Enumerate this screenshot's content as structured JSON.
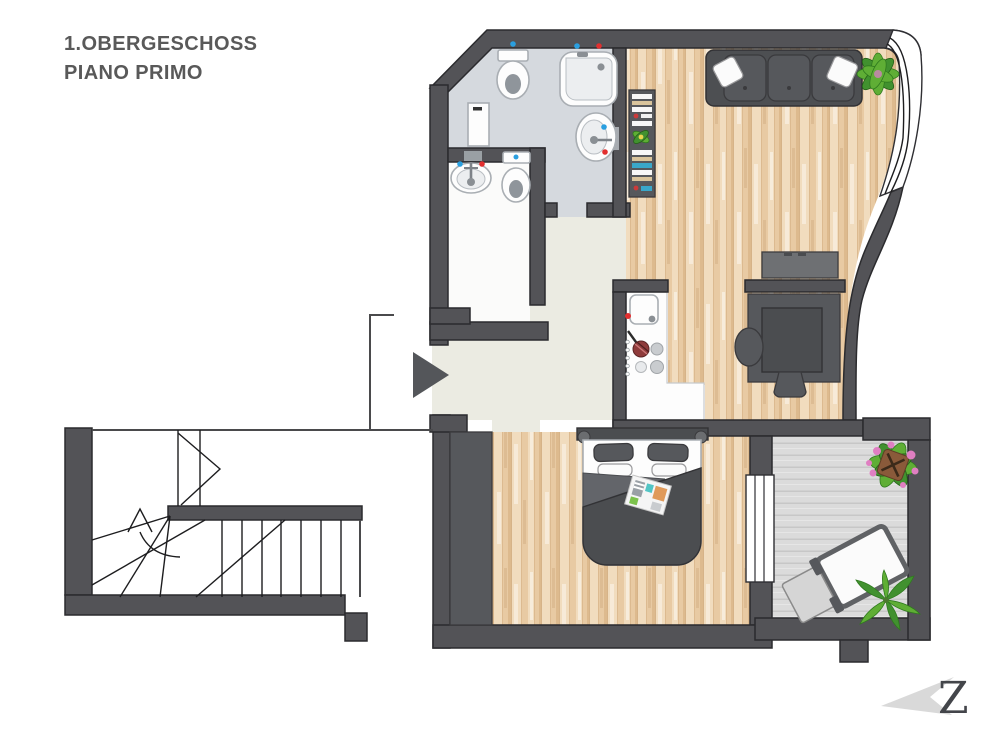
{
  "title": {
    "line1": "1.OBERGESCHOSS",
    "line2": "PIANO PRIMO"
  },
  "logo": {
    "letter": "Z"
  },
  "palette": {
    "wall": "#535357",
    "outline": "#2b2b2e",
    "bath_floor": "#d5d9de",
    "wc_floor": "#fbfbfa",
    "hall_floor": "#ebebe2",
    "wood_mid": "#e8caa3",
    "wood_light": "#f1dcbe",
    "wood_dark": "#ddba8e",
    "wood_grain": "#d2ae84",
    "deck": "#dbdbdb",
    "deck_line": "#c7c7c7",
    "furniture_dark": "#4b4d50",
    "furniture_mid": "#56585c",
    "furniture_light": "#6e7073",
    "accent_cold": "#2a9fe0",
    "accent_hot": "#e22f2f",
    "plant_green": "#5fae35",
    "plant_dark": "#41912f",
    "flower_pink": "#e07fc2",
    "pot_brown": "#8a5a3a",
    "title_color": "#595959",
    "logo_gray": "#d9d9d9",
    "arrow": "#54565a"
  }
}
